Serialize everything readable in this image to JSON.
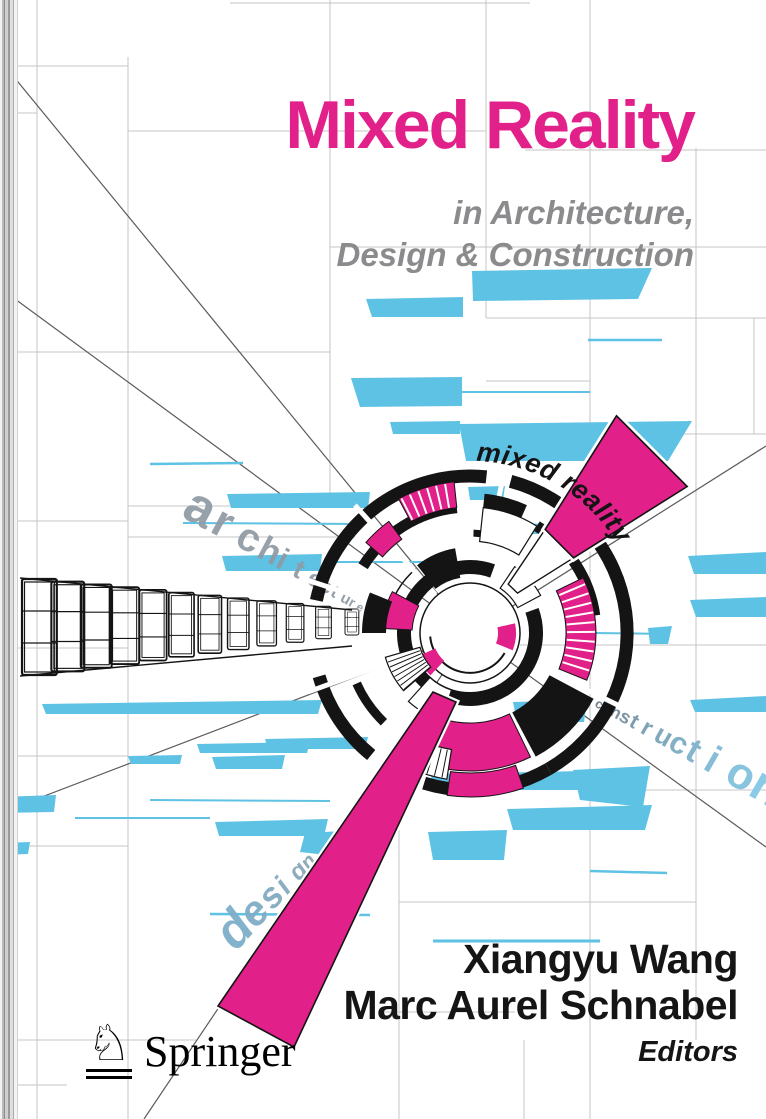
{
  "cover": {
    "title": "Mixed Reality",
    "subtitle_line1": "in Architecture,",
    "subtitle_line2": "Design & Construction",
    "authors": [
      "Xiangyu Wang",
      "Marc Aurel Schnabel"
    ],
    "editors_label": "Editors",
    "publisher": "Springer",
    "publisher_icon": "springer-horse-icon",
    "publisher_icon_glyph": "♘"
  },
  "artwork": {
    "arc_word": "mixed reality",
    "perspective_words": [
      {
        "text": "architecture",
        "x": 180,
        "y": 516,
        "angle": 28,
        "size": 52,
        "ratio": 0.875,
        "advance": 0.62,
        "color": "#8f9aa3",
        "color_end": "#8f9aa3",
        "italic": false,
        "opacity": 0.92
      },
      {
        "text": "construction",
        "x": 594,
        "y": 706,
        "angle": 30,
        "size": 13,
        "ratio": 1.13,
        "advance": 0.62,
        "color": "#6f7c86",
        "color_end": "#85c8e6",
        "italic": false,
        "opacity": 0.95
      },
      {
        "text": "design",
        "x": 236,
        "y": 952,
        "angle": -48,
        "size": 50,
        "ratio": 0.84,
        "advance": 0.6,
        "color": "#7dafca",
        "color_end": "#8ba6b5",
        "italic": true,
        "opacity": 0.95
      }
    ],
    "colors": {
      "pink": "#e2208a",
      "blue": "#5ec2e4",
      "ink": "#141414",
      "subtitle_gray": "#8b8b8d",
      "grid_gray": "#c6c6c6",
      "diagonal_gray": "#5b5b5b"
    }
  }
}
